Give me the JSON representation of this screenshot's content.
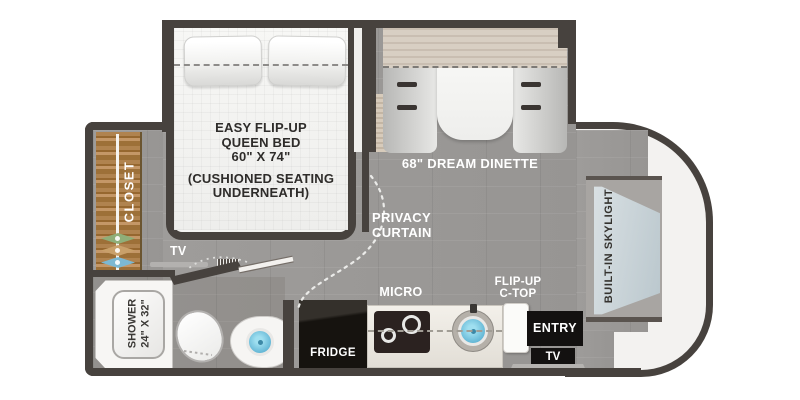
{
  "labels": {
    "bed": [
      "EASY FLIP-UP",
      "QUEEN BED",
      "60\" X 74\"",
      "(CUSHIONED SEATING",
      "UNDERNEATH)"
    ],
    "dinette": "68\" DREAM DINETTE",
    "privacy_curtain": [
      "PRIVACY",
      "CURTAIN"
    ],
    "closet": "CLOSET",
    "tv_bedroom": "TV",
    "shower": [
      "SHOWER",
      "24\" X 32\""
    ],
    "micro": "MICRO",
    "fridge": "FRIDGE",
    "flip_up_ctop": [
      "FLIP-UP",
      "C-TOP"
    ],
    "entry": "ENTRY",
    "tv_entry": "TV",
    "skylight": "BUILT-IN SKYLIGHT"
  },
  "colors": {
    "wall": "#47423e",
    "floor": "#9a9896",
    "rear_cap": "#f3f2f0",
    "closet_wood": "#a87a48",
    "hanger_green": "#8fae78",
    "hanger_tan": "#c9a06a",
    "hanger_blue": "#7cb8d2",
    "sink_blue": "#55acce",
    "bench_gray": "#d4d4d2",
    "valance_beige": "#d8cfc3",
    "appliance_black": "#131110",
    "skylight_glass": "#c8d3d8"
  }
}
